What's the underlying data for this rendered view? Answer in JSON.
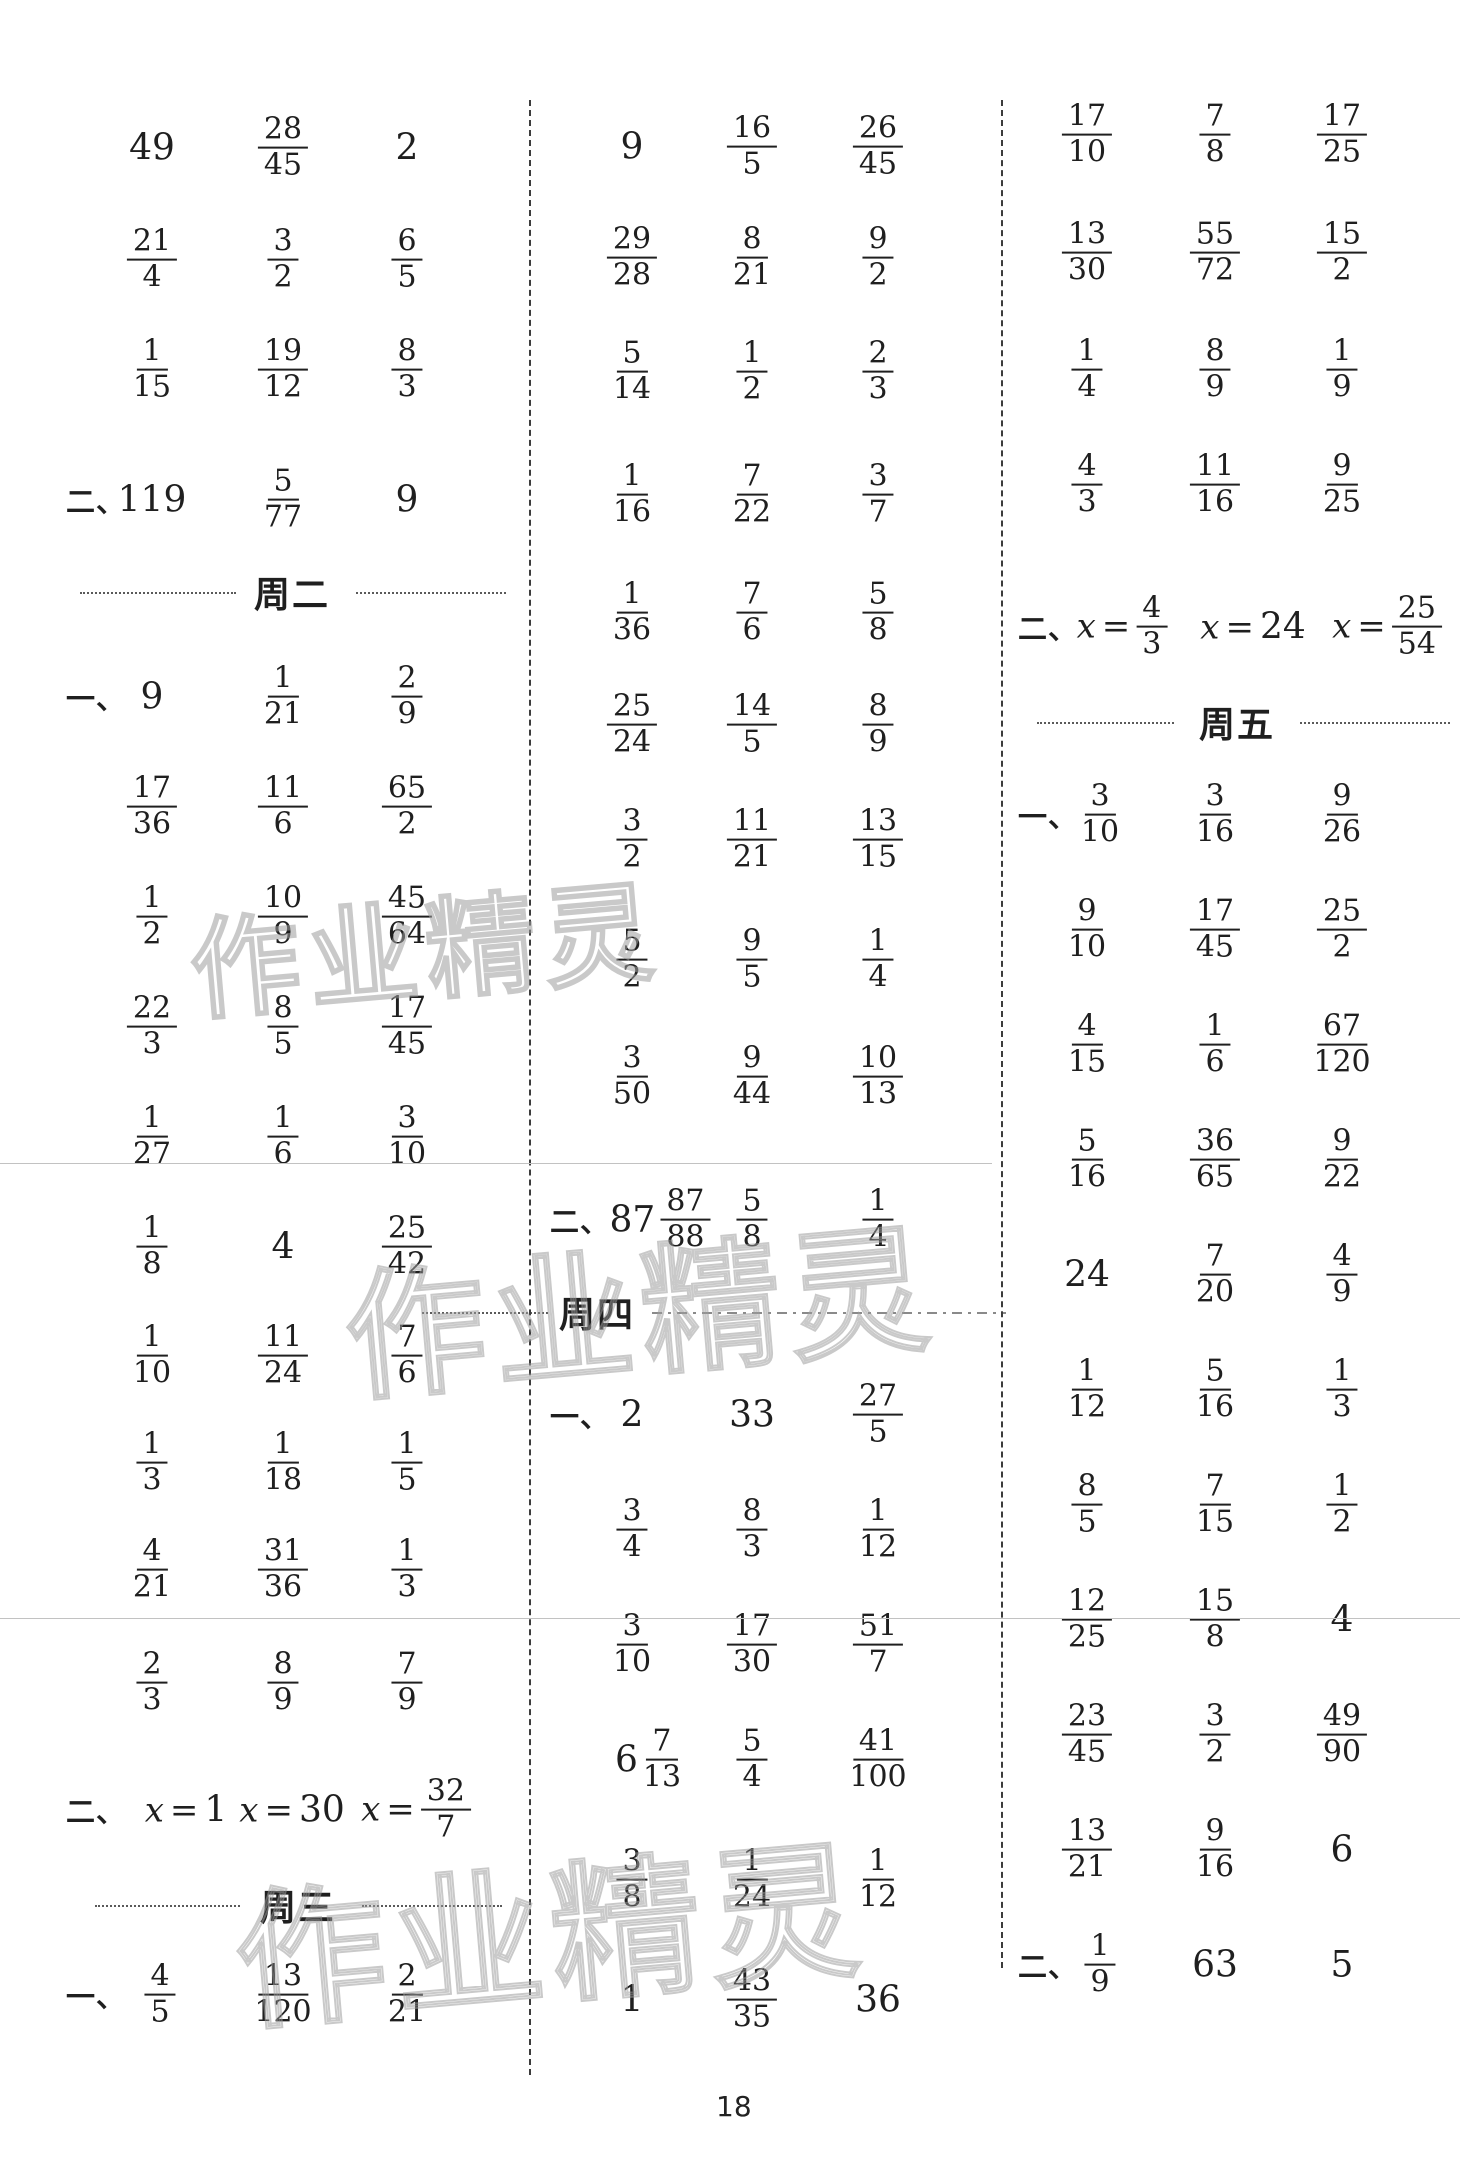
{
  "page_number": {
    "text": "18"
  },
  "watermark": {
    "text": "作业精灵"
  },
  "colors": {
    "ink": "#1f1f1f",
    "watermark_outline": "#9e9e9e",
    "divider": "#3c3c3c",
    "scan_artifact_line": "#c2c2c2"
  },
  "dividers": [
    {
      "x": 529,
      "y1": 100,
      "y2": 2075
    },
    {
      "x": 1001,
      "y1": 100,
      "y2": 1968
    }
  ],
  "artifact_lines": [
    {
      "y": 1163,
      "x1": 0,
      "x2": 992
    },
    {
      "y": 1618,
      "x1": 0,
      "x2": 1460
    }
  ],
  "watermarks": [
    {
      "x": 425,
      "y": 942,
      "size": 110
    },
    {
      "x": 640,
      "y": 1303,
      "size": 140
    },
    {
      "x": 550,
      "y": 1925,
      "size": 150
    }
  ],
  "columns": [
    {
      "cell_x": [
        152,
        283,
        407
      ],
      "label_x": 66,
      "items": [
        {
          "t": "row",
          "y": 148,
          "cells": [
            "49",
            "28/45",
            "2"
          ]
        },
        {
          "t": "row",
          "y": 260,
          "cells": [
            "21/4",
            "3/2",
            "6/5"
          ]
        },
        {
          "t": "row",
          "y": 370,
          "cells": [
            "1/15",
            "19/12",
            "8/3"
          ]
        },
        {
          "t": "row",
          "y": 500,
          "label": "二、",
          "cells": [
            "119",
            "5/77",
            "9"
          ]
        },
        {
          "t": "h",
          "y": 592,
          "cx": 292,
          "text": "周二",
          "left": [
            80,
            236
          ],
          "right": [
            356,
            506
          ],
          "right_style": "dotted"
        },
        {
          "t": "row",
          "y": 697,
          "label": "一、",
          "cells": [
            "9",
            "1/21",
            "2/9"
          ]
        },
        {
          "t": "row",
          "y": 807,
          "cells": [
            "17/36",
            "11/6",
            "65/2"
          ]
        },
        {
          "t": "row",
          "y": 917,
          "cells": [
            "1/2",
            "10/9",
            "45/64"
          ]
        },
        {
          "t": "row",
          "y": 1027,
          "cells": [
            "22/3",
            "8/5",
            "17/45"
          ]
        },
        {
          "t": "row",
          "y": 1137,
          "cells": [
            "1/27",
            "1/6",
            "3/10"
          ]
        },
        {
          "t": "row",
          "y": 1247,
          "cells": [
            "1/8",
            "4",
            "25/42"
          ]
        },
        {
          "t": "row",
          "y": 1356,
          "cells": [
            "1/10",
            "11/24",
            "7/6"
          ]
        },
        {
          "t": "row",
          "y": 1463,
          "cells": [
            "1/3",
            "1/18",
            "1/5"
          ]
        },
        {
          "t": "row",
          "y": 1570,
          "cells": [
            "4/21",
            "31/36",
            "1/3"
          ]
        },
        {
          "t": "row",
          "y": 1683,
          "cells": [
            "2/3",
            "8/9",
            "7/9"
          ]
        },
        {
          "t": "row",
          "y": 1810,
          "label": "二、",
          "dx": [
            186,
            292,
            416
          ],
          "cells": [
            "x=1",
            "x=30",
            "x=32/7"
          ]
        },
        {
          "t": "h",
          "y": 1905,
          "cx": 298,
          "text": "周三",
          "left": [
            95,
            240
          ],
          "right": [
            362,
            502
          ],
          "right_style": "dotted"
        },
        {
          "t": "row",
          "y": 1995,
          "label": "一、",
          "dx": [
            160,
            283,
            407
          ],
          "cells": [
            "4/5",
            "13/120",
            "2/21"
          ]
        }
      ]
    },
    {
      "cell_x": [
        632,
        752,
        878
      ],
      "label_x": 550,
      "items": [
        {
          "t": "row",
          "y": 147,
          "cells": [
            "9",
            "16/5",
            "26/45"
          ]
        },
        {
          "t": "row",
          "y": 258,
          "cells": [
            "29/28",
            "8/21",
            "9/2"
          ]
        },
        {
          "t": "row",
          "y": 372,
          "cells": [
            "5/14",
            "1/2",
            "2/3"
          ]
        },
        {
          "t": "row",
          "y": 495,
          "cells": [
            "1/16",
            "7/22",
            "3/7"
          ]
        },
        {
          "t": "row",
          "y": 613,
          "cells": [
            "1/36",
            "7/6",
            "5/8"
          ]
        },
        {
          "t": "row",
          "y": 725,
          "cells": [
            "25/24",
            "14/5",
            "8/9"
          ]
        },
        {
          "t": "row",
          "y": 840,
          "cells": [
            "3/2",
            "11/21",
            "13/15"
          ]
        },
        {
          "t": "row",
          "y": 960,
          "cells": [
            "5/2",
            "9/5",
            "1/4"
          ]
        },
        {
          "t": "row",
          "y": 1077,
          "cells": [
            "3/50",
            "9/44",
            "10/13"
          ]
        },
        {
          "t": "row",
          "y": 1220,
          "label": "二、",
          "dx": [
            660,
            752,
            878
          ],
          "cells": [
            "87 87/88",
            "5/8",
            "1/4"
          ]
        },
        {
          "t": "h",
          "y": 1312,
          "cx": 597,
          "text": "周四",
          "left": [
            422,
            548
          ],
          "right": [
            652,
            1006
          ],
          "right_style": "dashdot"
        },
        {
          "t": "row",
          "y": 1415,
          "label": "一、",
          "cells": [
            "2",
            "33",
            "27/5"
          ]
        },
        {
          "t": "row",
          "y": 1530,
          "cells": [
            "3/4",
            "8/3",
            "1/12"
          ]
        },
        {
          "t": "row",
          "y": 1645,
          "cells": [
            "3/10",
            "17/30",
            "51/7"
          ]
        },
        {
          "t": "row",
          "y": 1760,
          "dx": [
            648,
            752,
            878
          ],
          "cells": [
            "6 7/13",
            "5/4",
            "41/100"
          ]
        },
        {
          "t": "row",
          "y": 1880,
          "cells": [
            "3/8",
            "1/24",
            "1/12"
          ]
        },
        {
          "t": "row",
          "y": 2000,
          "cells": [
            "1",
            "43/35",
            "36"
          ]
        }
      ]
    },
    {
      "cell_x": [
        1087,
        1215,
        1342
      ],
      "label_x": 1018,
      "items": [
        {
          "t": "row",
          "y": 135,
          "cells": [
            "17/10",
            "7/8",
            "17/25"
          ]
        },
        {
          "t": "row",
          "y": 253,
          "cells": [
            "13/30",
            "55/72",
            "15/2"
          ]
        },
        {
          "t": "row",
          "y": 370,
          "cells": [
            "1/4",
            "8/9",
            "1/9"
          ]
        },
        {
          "t": "row",
          "y": 485,
          "cells": [
            "4/3",
            "11/16",
            "9/25"
          ]
        },
        {
          "t": "row",
          "y": 627,
          "label": "二、",
          "dx": [
            1122,
            1253,
            1387
          ],
          "cells": [
            "x=4/3",
            "x=24",
            "x=25/54"
          ]
        },
        {
          "t": "h",
          "y": 722,
          "cx": 1237,
          "text": "周五",
          "left": [
            1037,
            1174
          ],
          "right": [
            1300,
            1450
          ],
          "right_style": "dotted"
        },
        {
          "t": "row",
          "y": 815,
          "label": "一、",
          "dx": [
            1100,
            1215,
            1342
          ],
          "cells": [
            "3/10",
            "3/16",
            "9/26"
          ]
        },
        {
          "t": "row",
          "y": 930,
          "cells": [
            "9/10",
            "17/45",
            "25/2"
          ]
        },
        {
          "t": "row",
          "y": 1045,
          "cells": [
            "4/15",
            "1/6",
            "67/120"
          ]
        },
        {
          "t": "row",
          "y": 1160,
          "cells": [
            "5/16",
            "36/65",
            "9/22"
          ]
        },
        {
          "t": "row",
          "y": 1275,
          "cells": [
            "24",
            "7/20",
            "4/9"
          ]
        },
        {
          "t": "row",
          "y": 1390,
          "cells": [
            "1/12",
            "5/16",
            "1/3"
          ]
        },
        {
          "t": "row",
          "y": 1505,
          "cells": [
            "8/5",
            "7/15",
            "1/2"
          ]
        },
        {
          "t": "row",
          "y": 1620,
          "cells": [
            "12/25",
            "15/8",
            "4"
          ]
        },
        {
          "t": "row",
          "y": 1735,
          "cells": [
            "23/45",
            "3/2",
            "49/90"
          ]
        },
        {
          "t": "row",
          "y": 1850,
          "cells": [
            "13/21",
            "9/16",
            "6"
          ]
        },
        {
          "t": "row",
          "y": 1965,
          "label": "二、",
          "dx": [
            1100,
            1215,
            1342
          ],
          "cells": [
            "1/9",
            "63",
            "5"
          ]
        }
      ]
    }
  ]
}
